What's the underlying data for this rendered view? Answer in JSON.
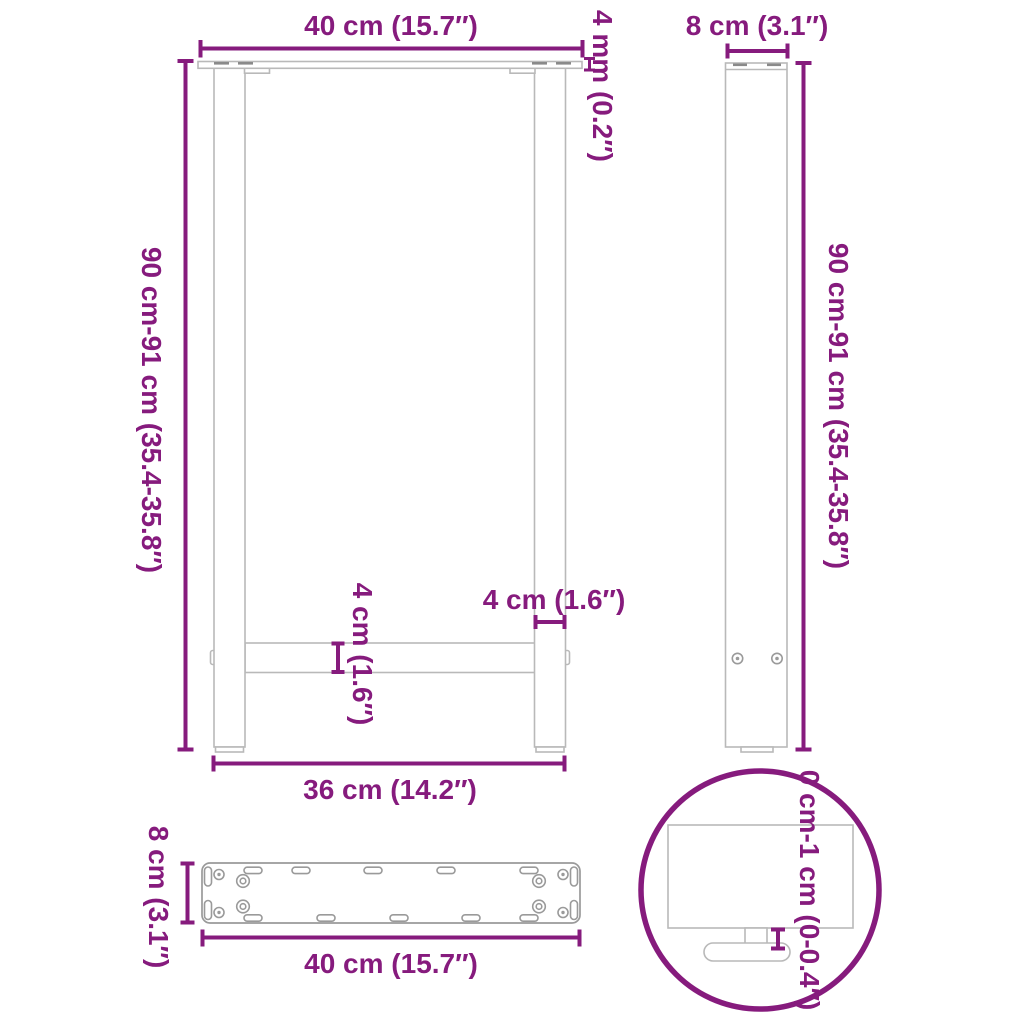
{
  "colors": {
    "accent": "#861b7d",
    "outline_gray": "#b9b9b9",
    "plate_gray": "#9a9a9a",
    "slot_gray": "#8a8a8a",
    "background": "#ffffff"
  },
  "diagram": {
    "subject": "table-leg-dimension-drawing",
    "front_view": {
      "top_width": "40 cm (15.7″)",
      "plate_thickness": "4 mm (0.2″)",
      "height": "90 cm-91 cm (35.4-35.8″)",
      "leg_profile_width": "4 cm (1.6″)",
      "crossbar_height": "4 cm (1.6″)",
      "bottom_width": "36 cm (14.2″)"
    },
    "side_view": {
      "depth": "8 cm (3.1″)",
      "height": "90 cm-91 cm (35.4-35.8″)"
    },
    "plate_view": {
      "depth": "8 cm (3.1″)",
      "width": "40 cm (15.7″)"
    },
    "detail_view": {
      "adjustable_range": "0 cm-1 cm (0-0.4″)"
    }
  }
}
